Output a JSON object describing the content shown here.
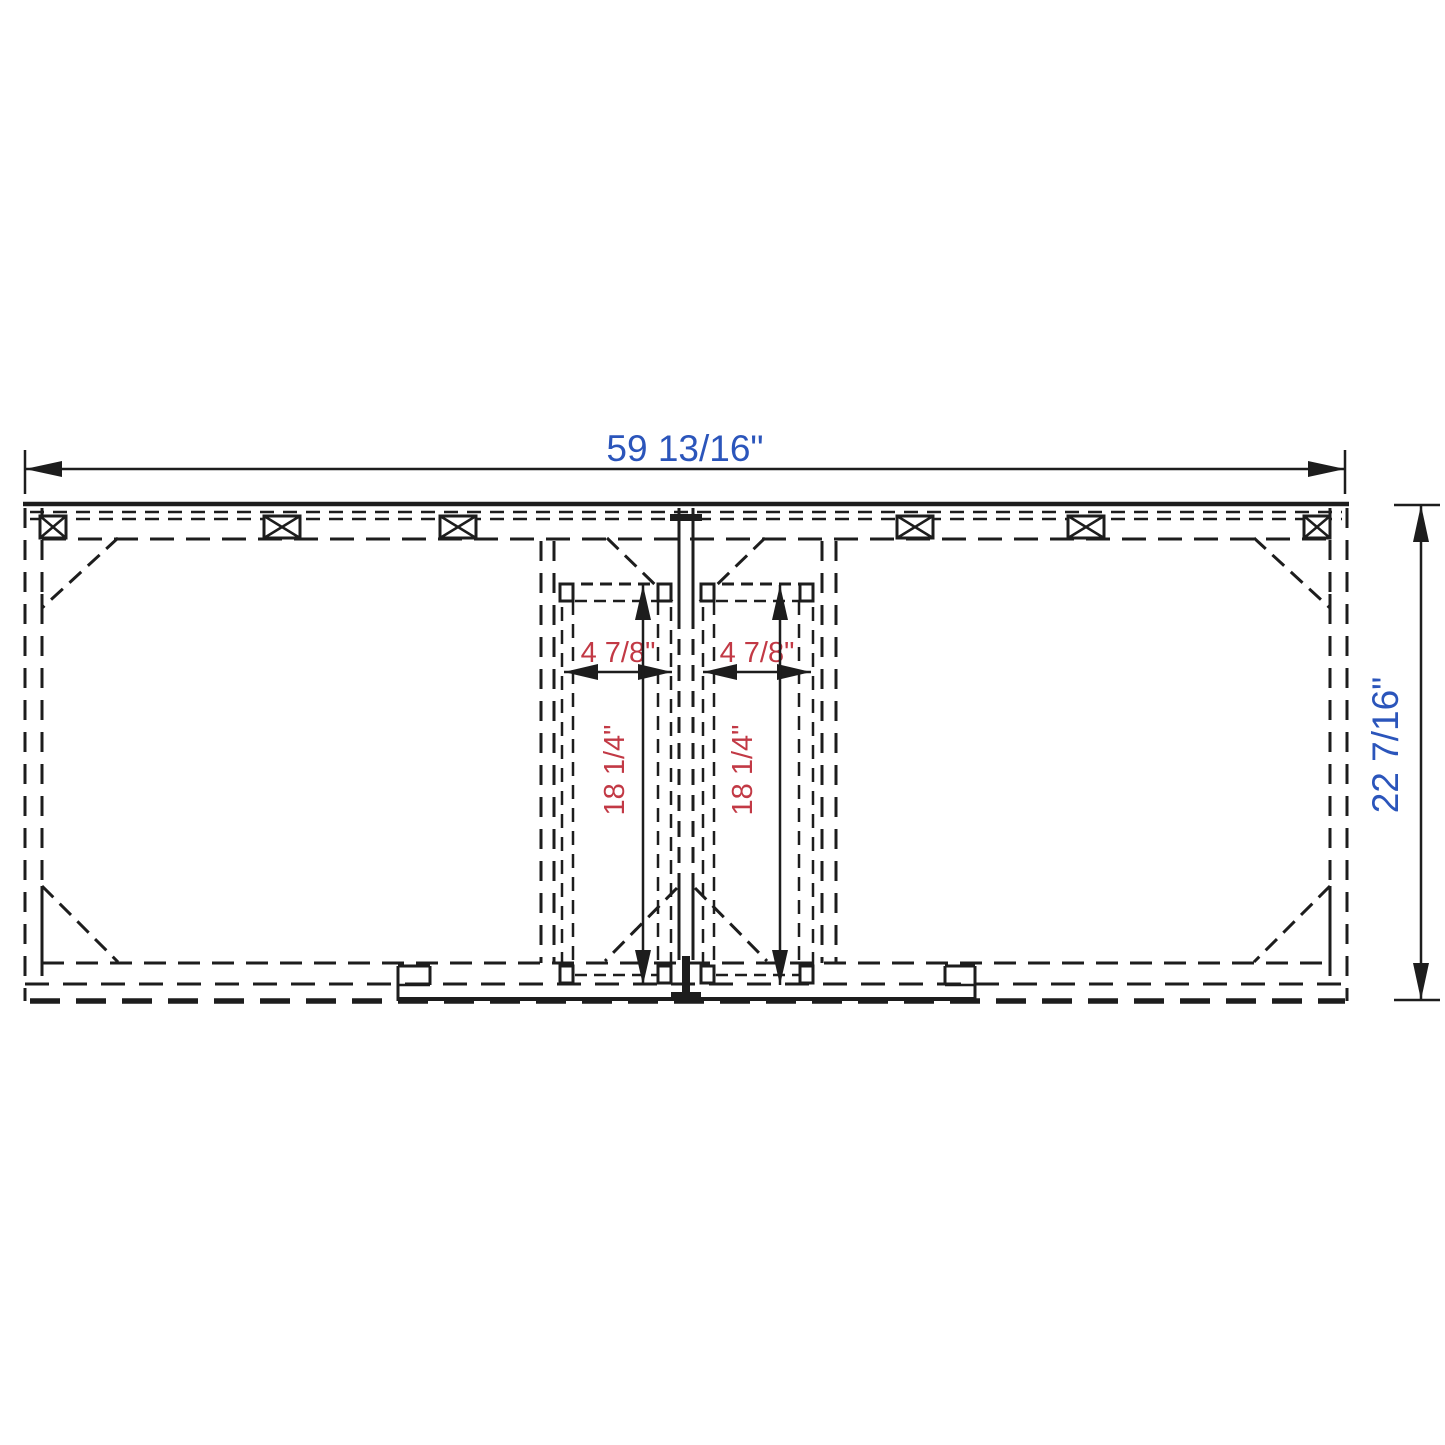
{
  "drawing": {
    "dimensions": {
      "overall_width": "59 13/16\"",
      "overall_depth": "22 7/16\"",
      "left_opening_width": "4 7/8\"",
      "right_opening_width": "4 7/8\"",
      "left_opening_depth": "18 1/4\"",
      "right_opening_depth": "18 1/4\""
    },
    "colors": {
      "line": "#1d1d1d",
      "dim_text_primary": "#2b55bb",
      "dim_text_secondary": "#c23945",
      "background": "#ffffff"
    }
  }
}
